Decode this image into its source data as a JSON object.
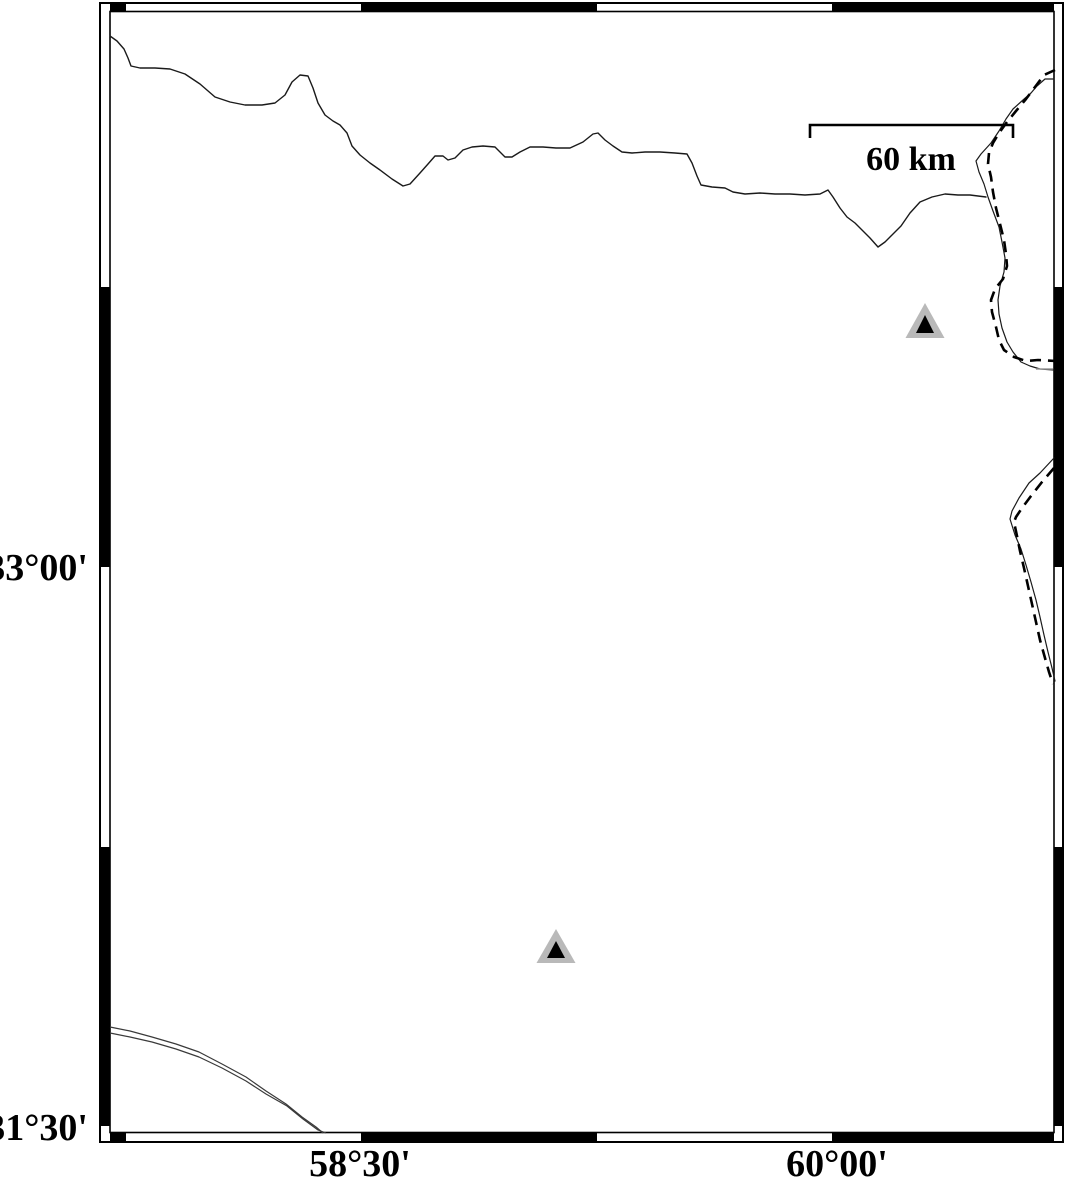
{
  "map": {
    "description": "black-and-white geographic map with fancy alternating frame, two station triangles, political borders and a scale bar",
    "axis": {
      "left_labels": [
        {
          "text": "33°00'"
        },
        {
          "text": "31°30'"
        }
      ],
      "bottom_labels": [
        {
          "text": "58°30'"
        },
        {
          "text": "60°00'"
        }
      ]
    },
    "scale_bar": {
      "label": "60 km"
    },
    "stations": [
      {
        "transform": "translate(925,338)"
      },
      {
        "transform": "translate(556,963)"
      }
    ],
    "colors": {
      "background": "#ffffff",
      "frame": "#000000",
      "border_line": "#1a1a1a",
      "dashed_line": "#000000",
      "double_line": "#3a3a3a",
      "station_outer": "#b9b9b9",
      "station_inner": "#000000"
    }
  }
}
